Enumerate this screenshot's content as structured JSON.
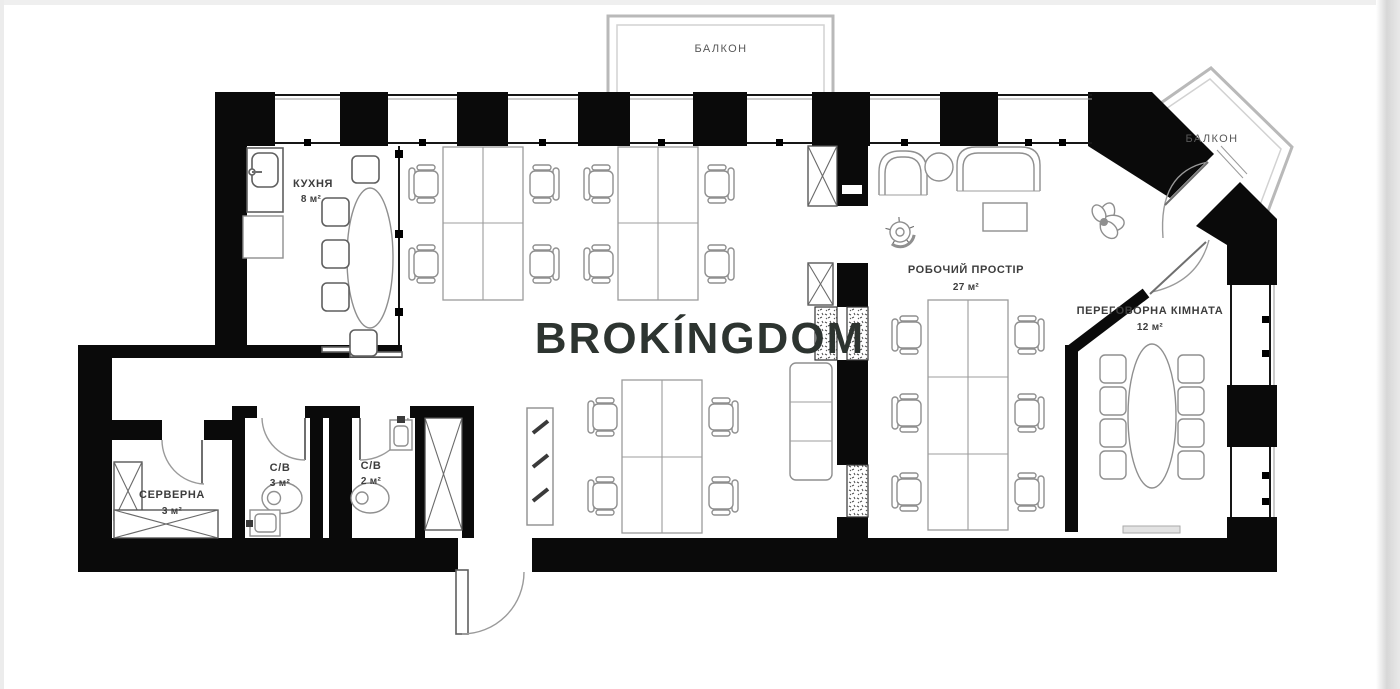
{
  "watermark": {
    "text": "BROKÍNGDOM"
  },
  "rooms": {
    "balcony_top": {
      "label": "БАЛКОН"
    },
    "balcony_right": {
      "label": "БАЛКОН"
    },
    "kitchen": {
      "label": "КУХНЯ",
      "area": "8 м²"
    },
    "work_space": {
      "label": "РОБОЧИЙ ПРОСТІР",
      "area": "27 м²"
    },
    "meeting_room": {
      "label": "ПЕРЕГОВОРНА КІМНАТА",
      "area": "12 м²"
    },
    "server_room": {
      "label": "СЕРВЕРНА",
      "area": "3 м²"
    },
    "bathroom_large": {
      "label": "С/В",
      "area": "3 м²"
    },
    "bathroom_small": {
      "label": "С/В",
      "area": "2 м²"
    }
  },
  "colors": {
    "wall": "#0a0a0a",
    "furniture": "#8f8f8f",
    "label": "#3d3d3d",
    "watermark": "#2d3430",
    "balcony_line": "#b9b9b9"
  }
}
